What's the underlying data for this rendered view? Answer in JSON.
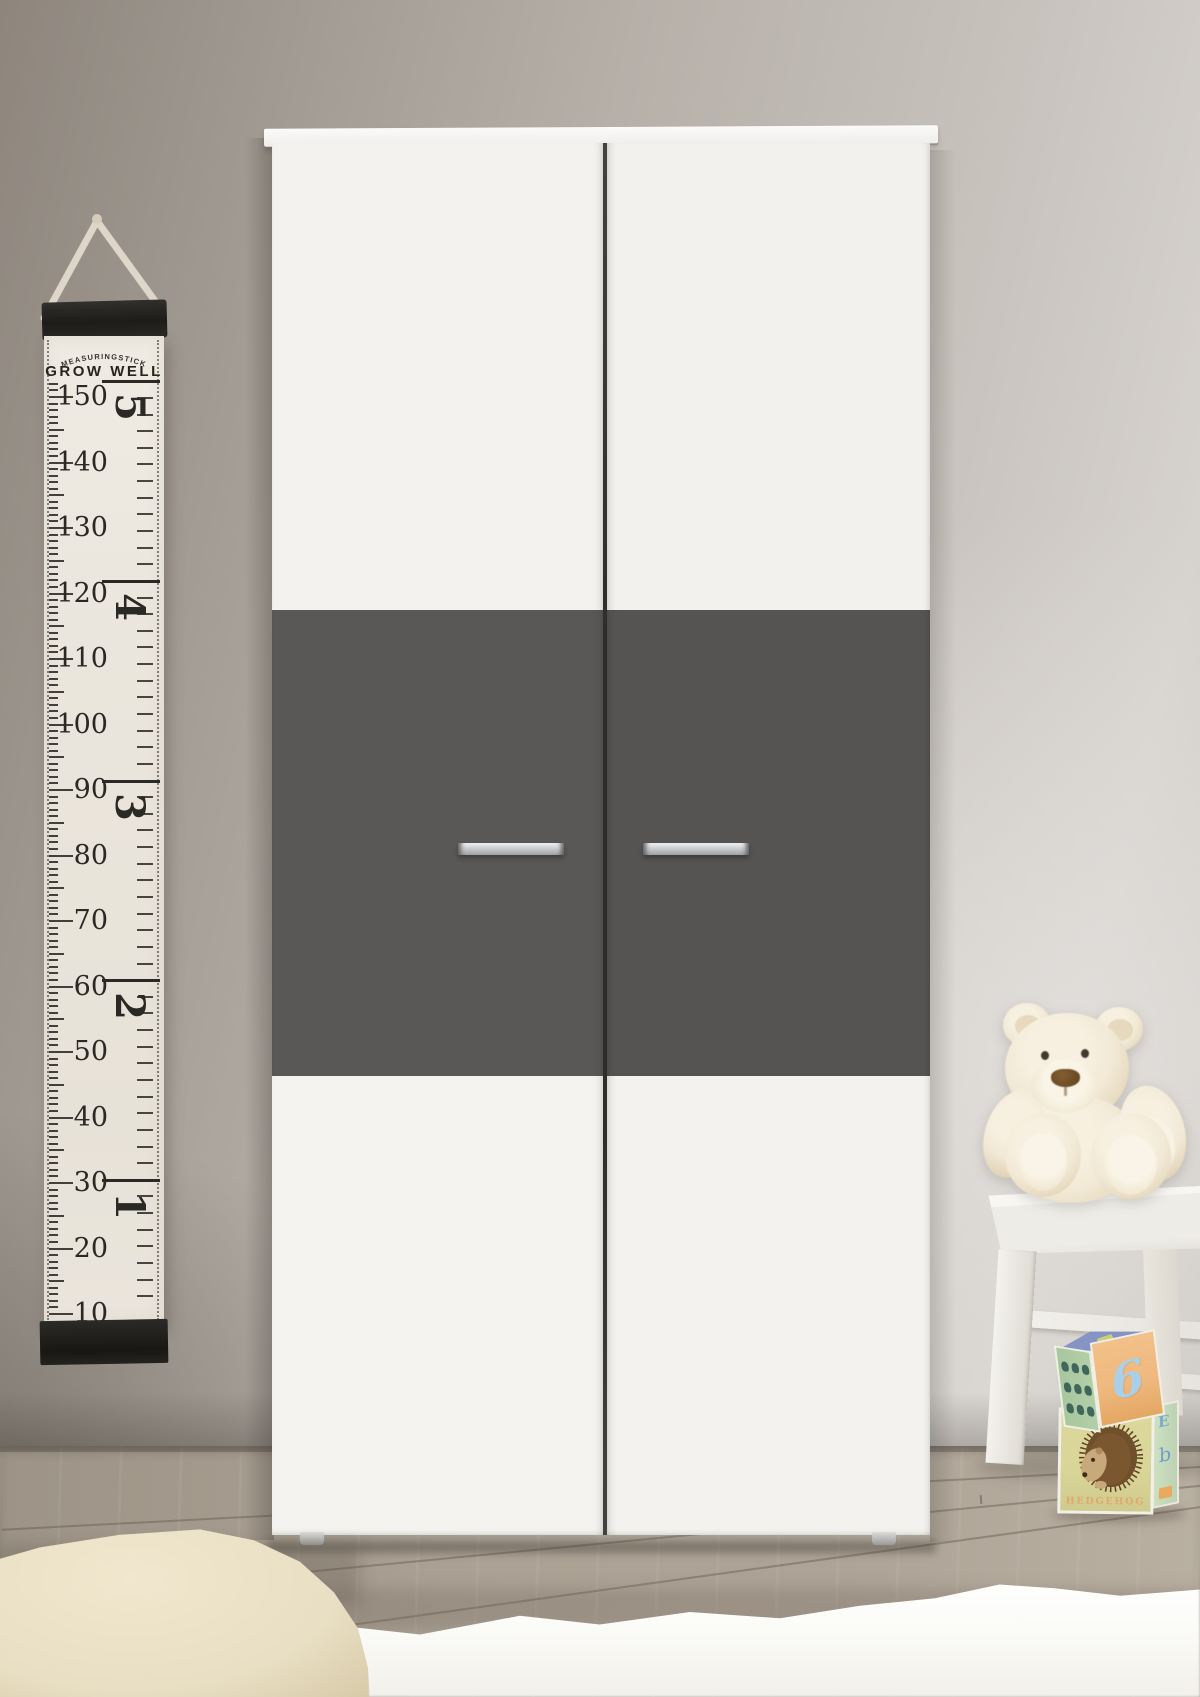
{
  "growth_chart": {
    "brand": "MEASURINGSTICK",
    "title": "GROW WELL",
    "cm_labels": [
      "150",
      "140",
      "130",
      "120",
      "110",
      "100",
      "90",
      "80",
      "70",
      "60",
      "50",
      "40",
      "30",
      "20",
      "10"
    ],
    "ft_labels": [
      "5",
      "4",
      "3",
      "2",
      "1"
    ]
  },
  "toy_blocks": {
    "number_block": {
      "number": "6"
    },
    "hedgehog_block": {
      "label": "HEDGEHOG",
      "side_letters": [
        "E",
        "b"
      ]
    }
  },
  "palette": {
    "wall_dark": "#8e867d",
    "wall_mid": "#b6b0a9",
    "wall_light": "#d6d2ce",
    "wardrobe_white": "#f3f2ef",
    "wardrobe_grey": "#5a5856",
    "handle_silver": "#c9cacc",
    "chart_canvas": "#ebe6dd",
    "chart_ink": "#2b2925",
    "floor": "#ada396",
    "rug_white": "#fbfbf8",
    "sheepskin": "#e9dfc4",
    "teddy_fur": "#f2e9d6",
    "teddy_nose": "#6b4a26",
    "stool": "#f2f0ec",
    "block_orange": "#efb97f",
    "block_green_face": "#b3cfa8",
    "block_grid": "#41675c",
    "block_top_blue": "#8694c4",
    "block_yellow": "#d9d598",
    "block_side_green": "#cde0c2",
    "number_blue": "#a9d0e8",
    "hedgehog_brown": "#7a572f",
    "hedgehog_label": "#e3a671",
    "letter_blue": "#7fa9cb"
  }
}
